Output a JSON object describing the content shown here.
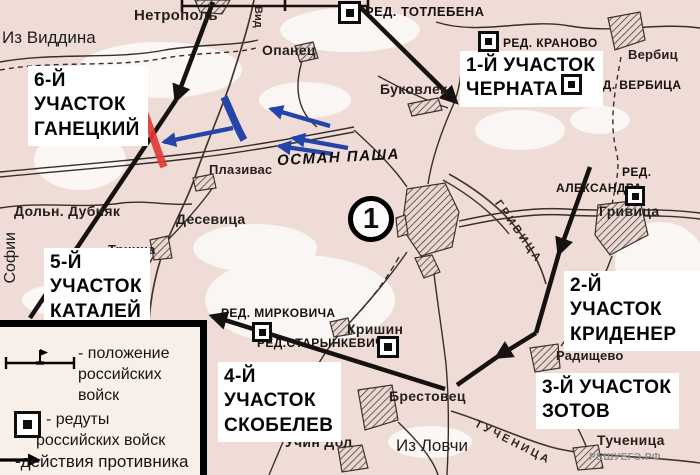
{
  "map_number": "1",
  "watermark": "РЕШУЕГЭ.РФ",
  "commander": "ОСМАН ПАША",
  "routes": {
    "viddin": "Из Виддина",
    "sofia": "Софии",
    "lovcha": "Из Ловчи"
  },
  "sectors": {
    "s1": {
      "l1": "1-Й УЧАСТОК",
      "l2": "ЧЕРНАТА"
    },
    "s2": {
      "l1": "2-Й УЧАСТОК",
      "l2": "КРИДЕНЕР"
    },
    "s3": {
      "l1": "3-Й УЧАСТОК",
      "l2": "ЗОТОВ"
    },
    "s4": {
      "l1": "4-Й",
      "l2": "УЧАСТОК",
      "l3": "СКОБЕЛЕВ"
    },
    "s5": {
      "l1": "5-Й",
      "l2": "УЧАСТОК",
      "l3": "КАТАЛЕЙ"
    },
    "s6": {
      "l1": "6-Й",
      "l2": "УЧАСТОК",
      "l3": "ГАНЕЦКИЙ"
    }
  },
  "redoubts": {
    "totlebena": "РЕД. ТОТЛЕБЕНА",
    "kranovo": "РЕД. КРАНОВО",
    "verbica": "РЕД. ВЕРБИЦА",
    "aleksandra_l1": "РЕД.",
    "aleksandra_l2": "АЛЕКСАНДРА",
    "mirkovicha": "РЕД. МИРКОВИЧА",
    "starynkevicha": "РЕД.СТАРЫНКЕВИЧА"
  },
  "places": {
    "netropol": "Нетрополь",
    "opanec": "Опанец",
    "bukovlek": "Буковлек",
    "verbic": "Вербиц",
    "plazivas": "Плазивас",
    "desevica": "Десевица",
    "trnina": "Трнина",
    "doln_dubnyak": "Дольн. Дубняк",
    "grivica": "Гривица",
    "krishin": "Кришин",
    "brestovec": "Брестовец",
    "uchin_dol": "Учин Дол",
    "radishchevo": "Радищево",
    "tuchenica": "Тученица"
  },
  "rivers": {
    "vid": "Вид",
    "grivica": "ГРИВИЦА",
    "tuchenica": "ТУЧЕНИЦА"
  },
  "legend": {
    "item1_l1": "- положение",
    "item1_l2": "российских",
    "item1_l3": "войск",
    "item2_l1": "- редуты",
    "item2_l2": "российских войск",
    "item3": "-действия противника"
  },
  "colors": {
    "paper": "#f0dcd6",
    "enemy_blue": "#2444aa",
    "front_red": "#e23a38",
    "line_black": "#151210"
  }
}
